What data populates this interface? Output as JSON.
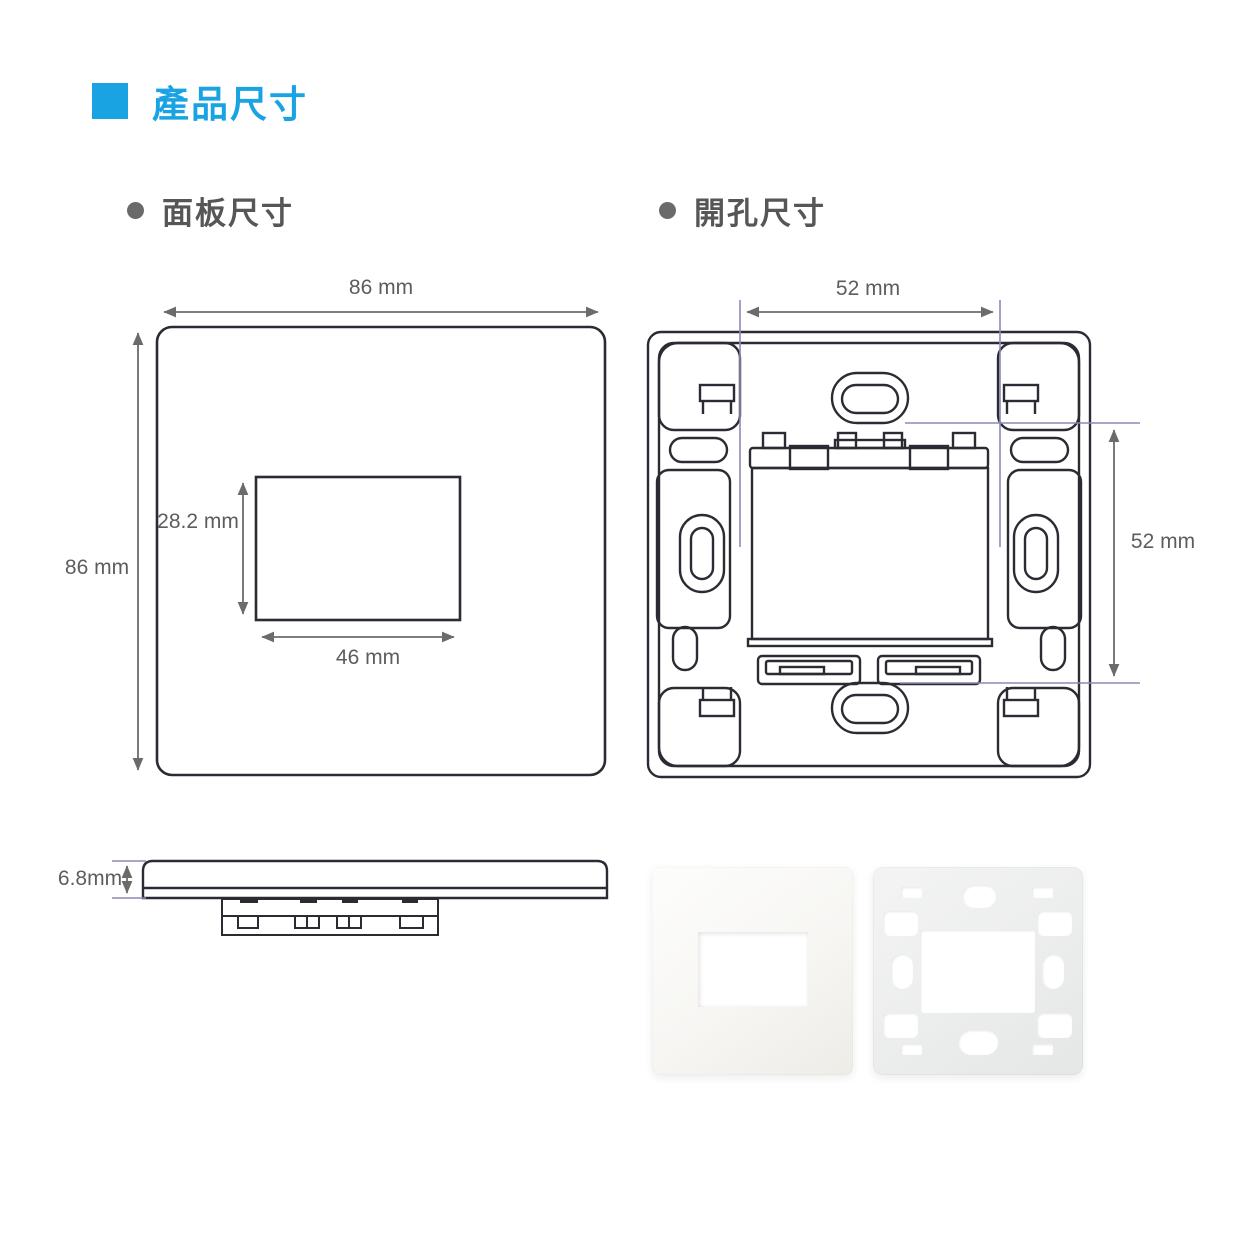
{
  "header": {
    "title": "產品尺寸"
  },
  "sections": {
    "panel": {
      "label": "面板尺寸"
    },
    "cutout": {
      "label": "開孔尺寸"
    }
  },
  "panel_diagram": {
    "width_label": "86 mm",
    "height_label": "86 mm",
    "opening_height_label": "28.2 mm",
    "opening_width_label": "46 mm"
  },
  "cutout_diagram": {
    "hole_spacing_horizontal_label": "52 mm",
    "hole_spacing_vertical_label": "52 mm"
  },
  "side_view": {
    "thickness_label": "6.8mm"
  },
  "colors": {
    "accent_blue": "#1aa3e3",
    "drawing_line": "#2b2b33",
    "dimension_line": "#6b6b6b",
    "extension_line": "#8a8ab8",
    "label_text": "#5d5d5d",
    "heading_text": "#565656"
  }
}
